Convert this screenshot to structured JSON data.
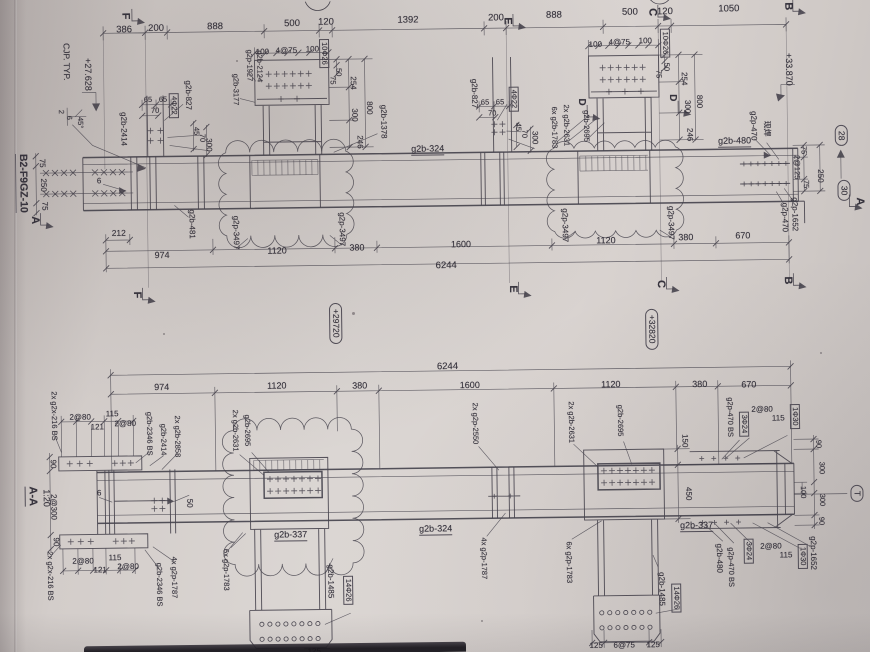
{
  "drawing": {
    "kind": "structural steel girder shop drawing (photographed sheet)",
    "drawing_number": "B2-F9GZ-10",
    "section_view": {
      "name": "A-A",
      "scale": "1:20"
    },
    "grid_bubbles": [
      "F",
      "E",
      "C",
      "B",
      "A",
      "D",
      "T",
      "28",
      "30"
    ],
    "elevation_marks": [
      "+27.628",
      "+33.870",
      "+29720",
      "+32820"
    ],
    "overall_length": "6244",
    "top_dim_chain": [
      "386",
      "200",
      "888",
      "500",
      "120",
      "1392",
      "200",
      "888",
      "500",
      "120",
      "1050"
    ],
    "span_dim_chain": [
      "974",
      "1120",
      "380",
      "1600",
      "1120",
      "380",
      "670"
    ],
    "weld_note": "CJP. TYP.",
    "site_weld_note": "现焊",
    "bolt_callouts": [
      "4Φ22",
      "10Φ26",
      "14Φ26",
      "3Φ24",
      "1Φ30"
    ],
    "member_marks": [
      "g2b-324",
      "g2b-337",
      "g2b-480",
      "g2b-481",
      "g2b-827",
      "g2b-1378",
      "g2b-1485",
      "g2b-1783",
      "g2b-2124",
      "g2b-2346",
      "g2b-2414",
      "g2b-2631",
      "g2b-2695",
      "g2b-2858",
      "g2b-3177",
      "g2p-470",
      "g2p-1652",
      "g2p-1783",
      "g2p-1787",
      "g2p-1927",
      "g2p-2550",
      "g2p-3497",
      "g2x-216"
    ]
  },
  "labels": [
    {
      "t": "386",
      "x": 128,
      "y": 26,
      "f": 9.5
    },
    {
      "t": "200",
      "x": 160,
      "y": 25,
      "f": 9.5
    },
    {
      "t": "888",
      "x": 219,
      "y": 24,
      "f": 9.5
    },
    {
      "t": "500",
      "x": 296,
      "y": 22,
      "f": 9.5
    },
    {
      "t": "120",
      "x": 330,
      "y": 21,
      "f": 9.5
    },
    {
      "t": "1392",
      "x": 412,
      "y": 20,
      "f": 9.5
    },
    {
      "t": "200",
      "x": 500,
      "y": 19,
      "f": 9.5
    },
    {
      "t": "888",
      "x": 558,
      "y": 17,
      "f": 9.5
    },
    {
      "t": "500",
      "x": 634,
      "y": 15,
      "f": 9.5
    },
    {
      "t": "120",
      "x": 669,
      "y": 15,
      "f": 9.5
    },
    {
      "t": "1050",
      "x": 733,
      "y": 13,
      "f": 9.5
    },
    {
      "t": "F",
      "x": 129,
      "y": 12,
      "r": 90,
      "f": 11,
      "b": 1,
      "k": "grid"
    },
    {
      "t": "E",
      "x": 511,
      "y": 22,
      "r": 90,
      "f": 11,
      "b": 1,
      "k": "grid"
    },
    {
      "t": "C",
      "x": 656,
      "y": 15,
      "r": 90,
      "f": 11,
      "b": 1,
      "k": "grid"
    },
    {
      "t": "B",
      "x": 792,
      "y": 11,
      "r": 90,
      "f": 11,
      "b": 1,
      "k": "grid"
    },
    {
      "t": "F",
      "x": 137,
      "y": 291,
      "r": 90,
      "f": 11,
      "b": 1,
      "k": "grid"
    },
    {
      "t": "E",
      "x": 513,
      "y": 290,
      "r": 90,
      "f": 11,
      "b": 1,
      "k": "grid"
    },
    {
      "t": "C",
      "x": 661,
      "y": 287,
      "r": 90,
      "f": 11,
      "b": 1,
      "k": "grid"
    },
    {
      "t": "B",
      "x": 788,
      "y": 285,
      "r": 90,
      "f": 11,
      "b": 1,
      "k": "grid"
    },
    {
      "t": "A",
      "x": 36,
      "y": 215,
      "r": 90,
      "f": 11,
      "b": 1,
      "k": "grid"
    },
    {
      "t": "A",
      "x": 861,
      "y": 207,
      "r": 90,
      "f": 11,
      "b": 1,
      "k": "grid"
    },
    {
      "t": "D",
      "x": 584,
      "y": 104,
      "r": 90,
      "f": 10,
      "b": 1,
      "k": "grid"
    },
    {
      "t": "D",
      "x": 675,
      "y": 101,
      "r": 90,
      "f": 10,
      "b": 1,
      "k": "grid"
    },
    {
      "t": "+27.628",
      "x": 91,
      "y": 70,
      "r": 90,
      "f": 9,
      "k": "elevation"
    },
    {
      "t": "+33.870",
      "x": 792,
      "y": 74,
      "r": 90,
      "f": 9,
      "k": "elevation"
    },
    {
      "t": "+29720",
      "x": 336,
      "y": 322,
      "r": 90,
      "f": 8.5,
      "st": 1,
      "k": "elevation"
    },
    {
      "t": "+32820",
      "x": 652,
      "y": 332,
      "r": 90,
      "f": 8.5,
      "st": 1,
      "k": "elevation"
    },
    {
      "t": "28",
      "x": 844,
      "y": 141,
      "r": 90,
      "f": 8.5,
      "st": 1,
      "k": "bubble"
    },
    {
      "t": "30",
      "x": 846,
      "y": 196,
      "r": 90,
      "f": 8.5,
      "st": 1,
      "k": "bubble"
    },
    {
      "t": "T",
      "x": 855,
      "y": 499,
      "r": 90,
      "f": 8.5,
      "st": 1,
      "k": "bubble"
    },
    {
      "t": "CJP. TYP.",
      "x": 70,
      "y": 57,
      "r": 90,
      "f": 8.5,
      "k": "note"
    },
    {
      "t": "现焊",
      "x": 769,
      "y": 133,
      "r": 90,
      "f": 8,
      "k": "note"
    },
    {
      "t": "2",
      "x": 64,
      "y": 107,
      "r": 90,
      "f": 7.5
    },
    {
      "t": "6",
      "x": 72,
      "y": 113,
      "r": 90,
      "f": 7.5
    },
    {
      "t": "45°",
      "x": 83,
      "y": 118,
      "r": 90,
      "f": 7.5
    },
    {
      "t": "B2-F9GZ-10",
      "x": 24,
      "y": 178,
      "r": 90,
      "f": 10.5,
      "b": 1,
      "u": 1,
      "k": "title"
    },
    {
      "t": "A-A",
      "x": 29,
      "y": 491,
      "r": 90,
      "f": 11,
      "b": 1,
      "u": 1,
      "k": "title"
    },
    {
      "t": "1:20",
      "x": 44,
      "y": 493,
      "r": 90,
      "f": 9,
      "k": "title"
    },
    {
      "t": "75",
      "x": 44,
      "y": 158,
      "r": 90,
      "f": 8
    },
    {
      "t": "250",
      "x": 45,
      "y": 180,
      "r": 90,
      "f": 8
    },
    {
      "t": "75",
      "x": 46,
      "y": 201,
      "r": 90,
      "f": 8
    },
    {
      "t": "6",
      "x": 101,
      "y": 177,
      "f": 8
    },
    {
      "t": "212",
      "x": 120,
      "y": 229,
      "f": 8.5
    },
    {
      "t": "974",
      "x": 163,
      "y": 252,
      "f": 9
    },
    {
      "t": "1120",
      "x": 278,
      "y": 249,
      "f": 9
    },
    {
      "t": "380",
      "x": 358,
      "y": 247,
      "f": 9
    },
    {
      "t": "1600",
      "x": 462,
      "y": 245,
      "f": 9
    },
    {
      "t": "1120",
      "x": 607,
      "y": 243,
      "f": 9
    },
    {
      "t": "380",
      "x": 687,
      "y": 241,
      "f": 9
    },
    {
      "t": "670",
      "x": 744,
      "y": 240,
      "f": 9
    },
    {
      "t": "6244",
      "x": 447,
      "y": 266,
      "f": 9.5
    },
    {
      "t": "65",
      "x": 151,
      "y": 96,
      "f": 7.5
    },
    {
      "t": "65",
      "x": 166,
      "y": 96,
      "f": 7.5
    },
    {
      "t": "70",
      "x": 158,
      "y": 107,
      "f": 7.5
    },
    {
      "t": "4Φ22",
      "x": 177,
      "y": 102,
      "r": 90,
      "f": 7.5,
      "bx": 1
    },
    {
      "t": "g2b-827",
      "x": 191,
      "y": 92,
      "r": 90,
      "f": 8,
      "k": "part"
    },
    {
      "t": "45",
      "x": 199,
      "y": 128,
      "r": 90,
      "f": 7.5
    },
    {
      "t": "70",
      "x": 205,
      "y": 135,
      "r": 90,
      "f": 7.5
    },
    {
      "t": "300",
      "x": 211,
      "y": 142,
      "r": 90,
      "f": 8
    },
    {
      "t": "g2b-2414",
      "x": 126,
      "y": 125,
      "r": 90,
      "f": 8,
      "k": "part"
    },
    {
      "t": "65",
      "x": 488,
      "y": 103,
      "f": 7.5
    },
    {
      "t": "65",
      "x": 503,
      "y": 103,
      "f": 7.5
    },
    {
      "t": "70",
      "x": 495,
      "y": 114,
      "f": 7.5
    },
    {
      "t": "4Φ22",
      "x": 517,
      "y": 100,
      "r": 90,
      "f": 7.5,
      "bx": 1
    },
    {
      "t": "g2b-827",
      "x": 477,
      "y": 94,
      "r": 90,
      "f": 8,
      "k": "part"
    },
    {
      "t": "45",
      "x": 521,
      "y": 128,
      "r": 90,
      "f": 7.5
    },
    {
      "t": "70",
      "x": 527,
      "y": 135,
      "r": 90,
      "f": 7.5
    },
    {
      "t": "300",
      "x": 537,
      "y": 139,
      "r": 90,
      "f": 8
    },
    {
      "t": "100",
      "x": 266,
      "y": 50,
      "f": 8
    },
    {
      "t": "4@75",
      "x": 290,
      "y": 49,
      "f": 8
    },
    {
      "t": "100",
      "x": 316,
      "y": 48,
      "f": 8
    },
    {
      "t": "10Φ26",
      "x": 328,
      "y": 52,
      "r": 90,
      "f": 7.5,
      "bx": 1
    },
    {
      "t": "g2p-1927",
      "x": 253,
      "y": 63,
      "r": 90,
      "f": 7.5,
      "k": "part"
    },
    {
      "t": "g2b-2124",
      "x": 263,
      "y": 64,
      "r": 90,
      "f": 7.5,
      "k": "part"
    },
    {
      "t": "g2b-3177",
      "x": 239,
      "y": 87,
      "r": 90,
      "f": 7.5,
      "k": "part"
    },
    {
      "t": "50",
      "x": 342,
      "y": 71,
      "r": 90,
      "f": 7.5
    },
    {
      "t": "75",
      "x": 336,
      "y": 79,
      "r": 90,
      "f": 7.5
    },
    {
      "t": "254",
      "x": 356,
      "y": 82,
      "r": 90,
      "f": 8
    },
    {
      "t": "300",
      "x": 357,
      "y": 114,
      "r": 90,
      "f": 8
    },
    {
      "t": "246",
      "x": 362,
      "y": 141,
      "r": 90,
      "f": 8
    },
    {
      "t": "800",
      "x": 372,
      "y": 107,
      "r": 90,
      "f": 8
    },
    {
      "t": "g2b-1378",
      "x": 386,
      "y": 121,
      "r": 90,
      "f": 8,
      "k": "part"
    },
    {
      "t": "100",
      "x": 599,
      "y": 47,
      "f": 8
    },
    {
      "t": "4@75",
      "x": 623,
      "y": 45,
      "f": 8
    },
    {
      "t": "100",
      "x": 649,
      "y": 44,
      "f": 8
    },
    {
      "t": "10Φ26",
      "x": 669,
      "y": 46,
      "r": 90,
      "f": 7.5,
      "bx": 1
    },
    {
      "t": "50",
      "x": 670,
      "y": 70,
      "r": 90,
      "f": 7.5
    },
    {
      "t": "75",
      "x": 662,
      "y": 77,
      "r": 90,
      "f": 7.5
    },
    {
      "t": "254",
      "x": 687,
      "y": 82,
      "r": 90,
      "f": 8
    },
    {
      "t": "300",
      "x": 690,
      "y": 110,
      "r": 90,
      "f": 8
    },
    {
      "t": "246",
      "x": 692,
      "y": 138,
      "r": 90,
      "f": 8
    },
    {
      "t": "800",
      "x": 702,
      "y": 105,
      "r": 90,
      "f": 8
    },
    {
      "t": "6x g2b-1783",
      "x": 557,
      "y": 129,
      "r": 90,
      "f": 7.5,
      "k": "part"
    },
    {
      "t": "2x g2b-2631",
      "x": 569,
      "y": 127,
      "r": 90,
      "f": 7.5,
      "k": "part"
    },
    {
      "t": "g2b-2695",
      "x": 589,
      "y": 128,
      "r": 90,
      "f": 7.5,
      "k": "part"
    },
    {
      "t": "g2b-324",
      "x": 430,
      "y": 150,
      "f": 9,
      "u": 1,
      "k": "part"
    },
    {
      "t": "g2b-480",
      "x": 737,
      "y": 146,
      "f": 9,
      "u": 1,
      "k": "part"
    },
    {
      "t": "g2b-481",
      "x": 193,
      "y": 221,
      "r": 90,
      "f": 8,
      "k": "part"
    },
    {
      "t": "g2p-3497",
      "x": 237,
      "y": 230,
      "r": 90,
      "f": 8,
      "k": "part"
    },
    {
      "t": "g2p-3497",
      "x": 343,
      "y": 228,
      "r": 90,
      "f": 8,
      "k": "part"
    },
    {
      "t": "g2p-3497",
      "x": 566,
      "y": 227,
      "r": 90,
      "f": 8,
      "k": "part"
    },
    {
      "t": "g2p-3497",
      "x": 672,
      "y": 226,
      "r": 90,
      "f": 8,
      "k": "part"
    },
    {
      "t": "g2p-470",
      "x": 756,
      "y": 130,
      "r": 90,
      "f": 8,
      "k": "part"
    },
    {
      "t": "75",
      "x": 806,
      "y": 155,
      "r": 90,
      "f": 7.5
    },
    {
      "t": "2@125",
      "x": 799,
      "y": 172,
      "r": 90,
      "f": 7.5
    },
    {
      "t": "75",
      "x": 808,
      "y": 189,
      "r": 90,
      "f": 7.5
    },
    {
      "t": "250",
      "x": 822,
      "y": 181,
      "r": 90,
      "f": 8
    },
    {
      "t": "g2p-1652",
      "x": 796,
      "y": 219,
      "r": 90,
      "f": 8,
      "k": "part"
    },
    {
      "t": "g2p-470",
      "x": 786,
      "y": 222,
      "r": 90,
      "f": 8,
      "k": "part"
    },
    {
      "t": "6244",
      "x": 447,
      "y": 367,
      "f": 9.5
    },
    {
      "t": "974",
      "x": 161,
      "y": 384,
      "f": 9
    },
    {
      "t": "1120",
      "x": 276,
      "y": 384,
      "f": 9
    },
    {
      "t": "380",
      "x": 359,
      "y": 385,
      "f": 9
    },
    {
      "t": "1600",
      "x": 469,
      "y": 386,
      "f": 9
    },
    {
      "t": "1120",
      "x": 610,
      "y": 387,
      "f": 9
    },
    {
      "t": "380",
      "x": 699,
      "y": 388,
      "f": 9
    },
    {
      "t": "670",
      "x": 748,
      "y": 389,
      "f": 9
    },
    {
      "t": "2x g2x-216 BS",
      "x": 53,
      "y": 411,
      "r": 90,
      "f": 7.5,
      "k": "part"
    },
    {
      "t": "2@80",
      "x": 79,
      "y": 413,
      "f": 8
    },
    {
      "t": "121",
      "x": 96,
      "y": 423,
      "f": 8
    },
    {
      "t": "115",
      "x": 111,
      "y": 410,
      "f": 8
    },
    {
      "t": "2@80",
      "x": 124,
      "y": 420,
      "f": 8
    },
    {
      "t": "g2b-2346 BS",
      "x": 148,
      "y": 430,
      "r": 90,
      "f": 7.5,
      "k": "part"
    },
    {
      "t": "g2b-2414",
      "x": 162,
      "y": 436,
      "r": 90,
      "f": 7.5,
      "k": "part"
    },
    {
      "t": "2x g2b-2858",
      "x": 176,
      "y": 433,
      "r": 90,
      "f": 7.5,
      "k": "part"
    },
    {
      "t": "2x g2b-2631",
      "x": 234,
      "y": 428,
      "r": 90,
      "f": 7.5,
      "k": "part"
    },
    {
      "t": "g2b-2695",
      "x": 246,
      "y": 428,
      "r": 90,
      "f": 7.5,
      "k": "part"
    },
    {
      "t": "90",
      "x": 51,
      "y": 459,
      "r": 90,
      "f": 8
    },
    {
      "t": "2@300",
      "x": 51,
      "y": 502,
      "r": 90,
      "f": 8
    },
    {
      "t": "90",
      "x": 53,
      "y": 537,
      "r": 90,
      "f": 8
    },
    {
      "t": "6",
      "x": 97,
      "y": 489,
      "f": 8
    },
    {
      "t": "50",
      "x": 187,
      "y": 500,
      "r": 90,
      "f": 8
    },
    {
      "t": "2x g2x-216 BS",
      "x": 47,
      "y": 571,
      "r": 90,
      "f": 7.5,
      "k": "part"
    },
    {
      "t": "2@80",
      "x": 80,
      "y": 557,
      "f": 8
    },
    {
      "t": "121",
      "x": 97,
      "y": 566,
      "f": 8
    },
    {
      "t": "115",
      "x": 112,
      "y": 554,
      "f": 8
    },
    {
      "t": "2@80",
      "x": 125,
      "y": 563,
      "f": 8
    },
    {
      "t": "g2b-2346 BS",
      "x": 156,
      "y": 581,
      "r": 90,
      "f": 7.5,
      "k": "part"
    },
    {
      "t": "4x g2p-1787",
      "x": 171,
      "y": 574,
      "r": 90,
      "f": 7.5,
      "k": "part"
    },
    {
      "t": "6x g2p-1783",
      "x": 223,
      "y": 567,
      "r": 90,
      "f": 7.5,
      "k": "part"
    },
    {
      "t": "g2b-337",
      "x": 288,
      "y": 534,
      "f": 9,
      "u": 1,
      "k": "part"
    },
    {
      "t": "g2b-324",
      "x": 433,
      "y": 530,
      "f": 9,
      "u": 1,
      "k": "part"
    },
    {
      "t": "2x g2p-2550",
      "x": 474,
      "y": 424,
      "r": 90,
      "f": 7.5,
      "k": "part"
    },
    {
      "t": "4x g2p-1787",
      "x": 481,
      "y": 559,
      "r": 90,
      "f": 7.5,
      "k": "part"
    },
    {
      "t": "g2b-1485",
      "x": 327,
      "y": 580,
      "r": 90,
      "f": 8,
      "k": "part"
    },
    {
      "t": "14Φ26",
      "x": 345,
      "y": 589,
      "r": 90,
      "f": 7.5,
      "bx": 1
    },
    {
      "t": "125",
      "x": 310,
      "y": 650,
      "f": 8
    },
    {
      "t": "2x g2b-2631",
      "x": 570,
      "y": 424,
      "r": 90,
      "f": 7.5,
      "k": "part"
    },
    {
      "t": "g2b-2695",
      "x": 619,
      "y": 423,
      "r": 90,
      "f": 7.5,
      "k": "part"
    },
    {
      "t": "150",
      "x": 683,
      "y": 444,
      "r": 90,
      "f": 8
    },
    {
      "t": "450",
      "x": 686,
      "y": 497,
      "r": 90,
      "f": 8
    },
    {
      "t": "6x g2p-1783",
      "x": 566,
      "y": 564,
      "r": 90,
      "f": 7.5,
      "k": "part"
    },
    {
      "t": "g2b-337",
      "x": 694,
      "y": 530,
      "f": 9,
      "u": 1,
      "k": "part"
    },
    {
      "t": "g2b-1485",
      "x": 658,
      "y": 592,
      "r": 90,
      "f": 8,
      "k": "part"
    },
    {
      "t": "14Φ26",
      "x": 673,
      "y": 601,
      "r": 90,
      "f": 7.5,
      "bx": 1
    },
    {
      "t": "125",
      "x": 592,
      "y": 648,
      "f": 8
    },
    {
      "t": "6@75",
      "x": 620,
      "y": 648,
      "f": 8
    },
    {
      "t": "125",
      "x": 649,
      "y": 648,
      "f": 8
    },
    {
      "t": "g2p-470 BS",
      "x": 729,
      "y": 421,
      "r": 90,
      "f": 7.5,
      "k": "part"
    },
    {
      "t": "3Φ24",
      "x": 743,
      "y": 428,
      "r": 90,
      "f": 7.5,
      "bx": 1
    },
    {
      "t": "2@80",
      "x": 761,
      "y": 414,
      "f": 8
    },
    {
      "t": "115",
      "x": 777,
      "y": 423,
      "f": 8
    },
    {
      "t": "1Φ30",
      "x": 794,
      "y": 421,
      "r": 90,
      "f": 7.5,
      "bx": 1
    },
    {
      "t": "90",
      "x": 817,
      "y": 449,
      "r": 90,
      "f": 7.5
    },
    {
      "t": "300",
      "x": 820,
      "y": 473,
      "r": 90,
      "f": 7.5
    },
    {
      "t": "100",
      "x": 801,
      "y": 497,
      "r": 90,
      "f": 7.5
    },
    {
      "t": "300",
      "x": 820,
      "y": 505,
      "r": 90,
      "f": 7.5
    },
    {
      "t": "90",
      "x": 819,
      "y": 526,
      "r": 90,
      "f": 7.5
    },
    {
      "t": "g2b-480",
      "x": 716,
      "y": 562,
      "r": 90,
      "f": 8,
      "k": "part"
    },
    {
      "t": "g2p-470 BS",
      "x": 728,
      "y": 571,
      "r": 90,
      "f": 7.5,
      "k": "part"
    },
    {
      "t": "3Φ24",
      "x": 746,
      "y": 555,
      "r": 90,
      "f": 7.5,
      "bx": 1
    },
    {
      "t": "2@80",
      "x": 768,
      "y": 551,
      "f": 8
    },
    {
      "t": "115",
      "x": 783,
      "y": 560,
      "f": 8
    },
    {
      "t": "1Φ30",
      "x": 800,
      "y": 561,
      "r": 90,
      "f": 7.5,
      "bx": 1
    },
    {
      "t": "g2p-1652",
      "x": 810,
      "y": 558,
      "r": 90,
      "f": 8,
      "k": "part"
    }
  ]
}
